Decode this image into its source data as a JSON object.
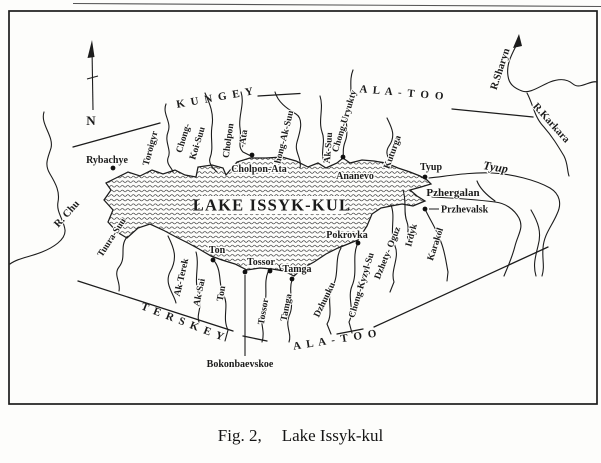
{
  "figure": {
    "caption_prefix": "Fig. 2,",
    "caption_title": "Lake Issyk-kul"
  },
  "map": {
    "compass_label": "N",
    "lake_name": "LAKE ISSYK-KUL",
    "ink_color": "#1c1c1c",
    "paper_color": "#fdfdfb",
    "ranges": [
      {
        "id": "kungey",
        "label": "K U N G E Y"
      },
      {
        "id": "ala-too-north",
        "label": "A L A  -  T O O"
      },
      {
        "id": "terskey",
        "label": "T E R S K E Y"
      },
      {
        "id": "ala-too-south",
        "label": "A L A  -  T O O"
      }
    ],
    "towns": [
      {
        "name": "Rybachye"
      },
      {
        "name": "Cholpon-Ata"
      },
      {
        "name": "Ananevo"
      },
      {
        "name": "Tyup"
      },
      {
        "name": "Przhevalsk"
      },
      {
        "name": "Pokrovka"
      },
      {
        "name": "Ton"
      },
      {
        "name": "Tossor"
      },
      {
        "name": "Tamga"
      },
      {
        "name": "Bokonbaevskoe"
      }
    ],
    "rivers": [
      {
        "name": "R. Chu"
      },
      {
        "name": "Toroigyr"
      },
      {
        "name": "Chong-",
        "name2": "Koi-Suu"
      },
      {
        "name": "Cholpon",
        "name2": "-Ata"
      },
      {
        "name": "Chong-Ak-Suu"
      },
      {
        "name": "Ak-Suu"
      },
      {
        "name": "Chong-Uryukty"
      },
      {
        "name": "Kuturga"
      },
      {
        "name": "Tyup"
      },
      {
        "name": "R.Sharyn"
      },
      {
        "name": "R.Karkara"
      },
      {
        "name": "Pzhergalan"
      },
      {
        "name": "Karakol"
      },
      {
        "name": "Irdyk"
      },
      {
        "name": "Dzhety- Oguz"
      },
      {
        "name": "Chong-Kyzyl-Su"
      },
      {
        "name": "Dzhuuku"
      },
      {
        "name": "Tamga"
      },
      {
        "name": "Tossor"
      },
      {
        "name": "Ton"
      },
      {
        "name": "Ak-Sai"
      },
      {
        "name": "Ak-Terek"
      },
      {
        "name": "Tuura-Suu"
      }
    ]
  }
}
